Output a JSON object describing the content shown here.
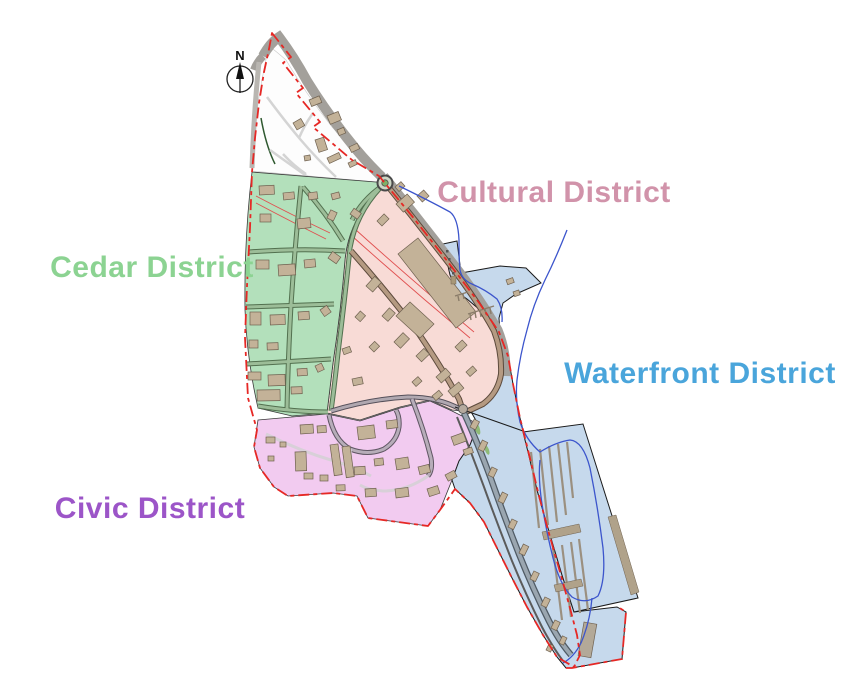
{
  "map": {
    "compass": {
      "label": "N"
    },
    "districts": [
      {
        "name": "Cedar District",
        "label_color": "#8cd392",
        "fill": "#b3e0bb"
      },
      {
        "name": "Cultural District",
        "label_color": "#d193aa",
        "fill": "#f8dbd6"
      },
      {
        "name": "Waterfront District",
        "label_color": "#4aa5db",
        "fill": "#c6d9ec"
      },
      {
        "name": "Civic District",
        "label_color": "#9c55c8",
        "fill": "#f2cbf0"
      }
    ],
    "boundary_color": "#e62825",
    "stream_color": "#3c55cc",
    "building_color": "#c3b298",
    "road_band_color": "#a3a09b"
  }
}
